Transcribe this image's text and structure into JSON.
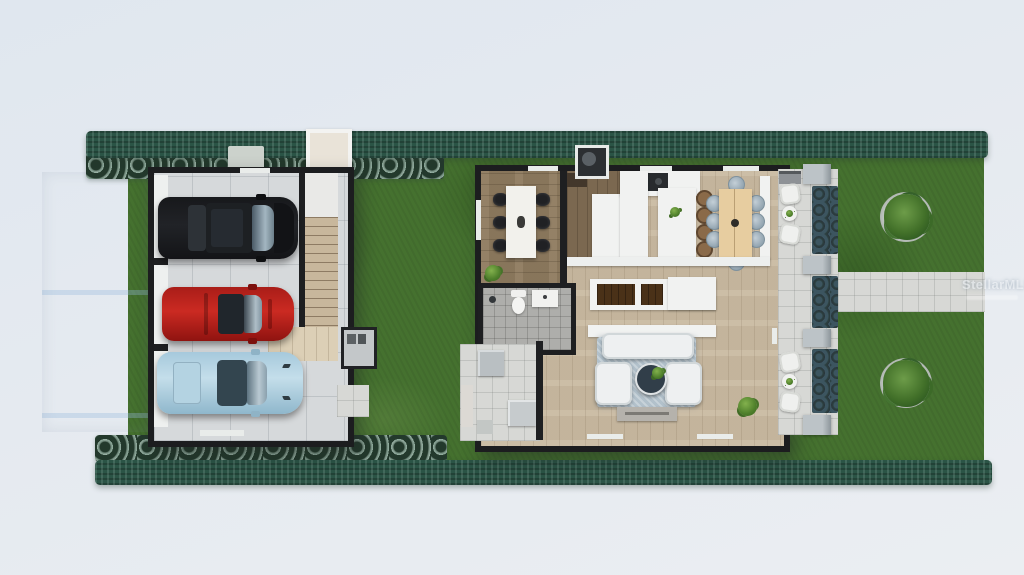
{
  "watermark": {
    "text": "StellarMLS"
  },
  "scene": {
    "kind": "top-down 3D architectural rendering of a narrow-lot single-family home",
    "palette": {
      "background": "#e5eaf0",
      "grass": "#45712f",
      "hedge": "#2b5446",
      "groundcover": "#97b2a4",
      "driveway": "#d2dbe4",
      "walls": "#1e1f21",
      "wood_floor": "#c9baa2",
      "dining_wood": "#8e7b60",
      "patio_pavers": "#d7d8d5",
      "suv_black": "#17181b",
      "sports_car_red": "#c02420",
      "sports_car_blue": "#b7d5e5",
      "sofa_white": "#eef0f1",
      "rug_blue_grey": "#b2c1cb",
      "nook_table_tan": "#e7cda0"
    },
    "lot": {
      "zones": [
        "driveway",
        "front groundcover bed",
        "top hedge row",
        "lawn",
        "bottom hedge row",
        "backyard walkway"
      ],
      "trees": 2
    },
    "garage": {
      "bays": 3,
      "cars": [
        "black SUV",
        "red sports car",
        "light blue sports car"
      ],
      "features": [
        "interior staircase",
        "stair landing",
        "exterior AC unit",
        "garage door wall"
      ]
    },
    "house": {
      "rooms": [
        "dining room",
        "pantry",
        "kitchen",
        "breakfast nook",
        "bathroom",
        "stair core",
        "living room"
      ],
      "furniture_counts": {
        "dining_chairs": 6,
        "nook_chairs": 8,
        "bar_stools": 4,
        "sofas": 3,
        "coffee_table": 1,
        "tv_console": 1,
        "plants": 3
      },
      "bathroom_fixtures": [
        "toilet",
        "vanity sink",
        "shower fixture"
      ]
    },
    "patio": {
      "seating_groups": 2,
      "chairs": 4,
      "side_tables": 2,
      "planters": 3,
      "columns": 4,
      "outdoor_grill": 1
    }
  }
}
